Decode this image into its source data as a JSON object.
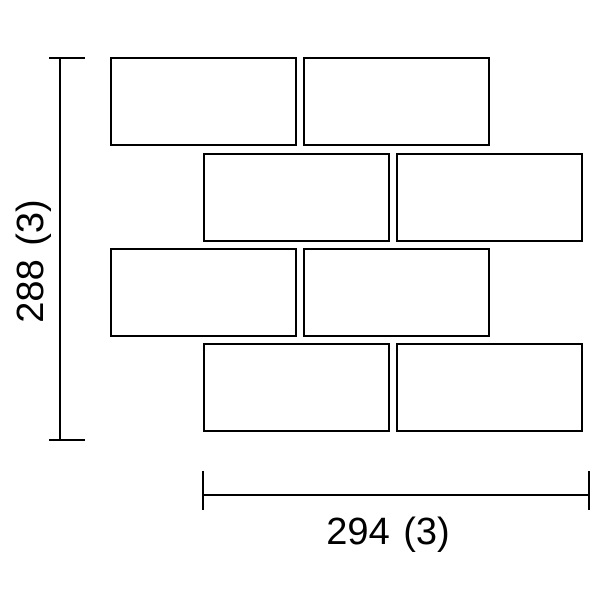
{
  "page": {
    "background": "#ffffff"
  },
  "drawing": {
    "stroke_color": "#000000",
    "tile_fill": "#ffffff",
    "tiles": {
      "width": 187,
      "height": 89,
      "rows": [
        {
          "y": 57,
          "xs": [
            110,
            303
          ]
        },
        {
          "y": 153,
          "xs": [
            203,
            396
          ]
        },
        {
          "y": 248,
          "xs": [
            110,
            303
          ]
        },
        {
          "y": 343,
          "xs": [
            203,
            396
          ]
        }
      ]
    },
    "dimension_vertical": {
      "label": "288 (3)",
      "orientation": "vertical",
      "label_center": {
        "x": 31,
        "y": 261
      },
      "segments": [
        {
          "x": 59,
          "y": 57,
          "w": 2,
          "h": 384
        },
        {
          "x": 49,
          "y": 57,
          "w": 36,
          "h": 2
        },
        {
          "x": 49,
          "y": 439,
          "w": 36,
          "h": 2
        }
      ]
    },
    "dimension_horizontal": {
      "label": "294 (3)",
      "orientation": "horizontal",
      "label_center": {
        "x": 388,
        "y": 532
      },
      "segments": [
        {
          "x": 202,
          "y": 494,
          "w": 388,
          "h": 2
        },
        {
          "x": 202,
          "y": 471,
          "w": 2,
          "h": 39
        },
        {
          "x": 588,
          "y": 471,
          "w": 2,
          "h": 39
        }
      ]
    }
  }
}
